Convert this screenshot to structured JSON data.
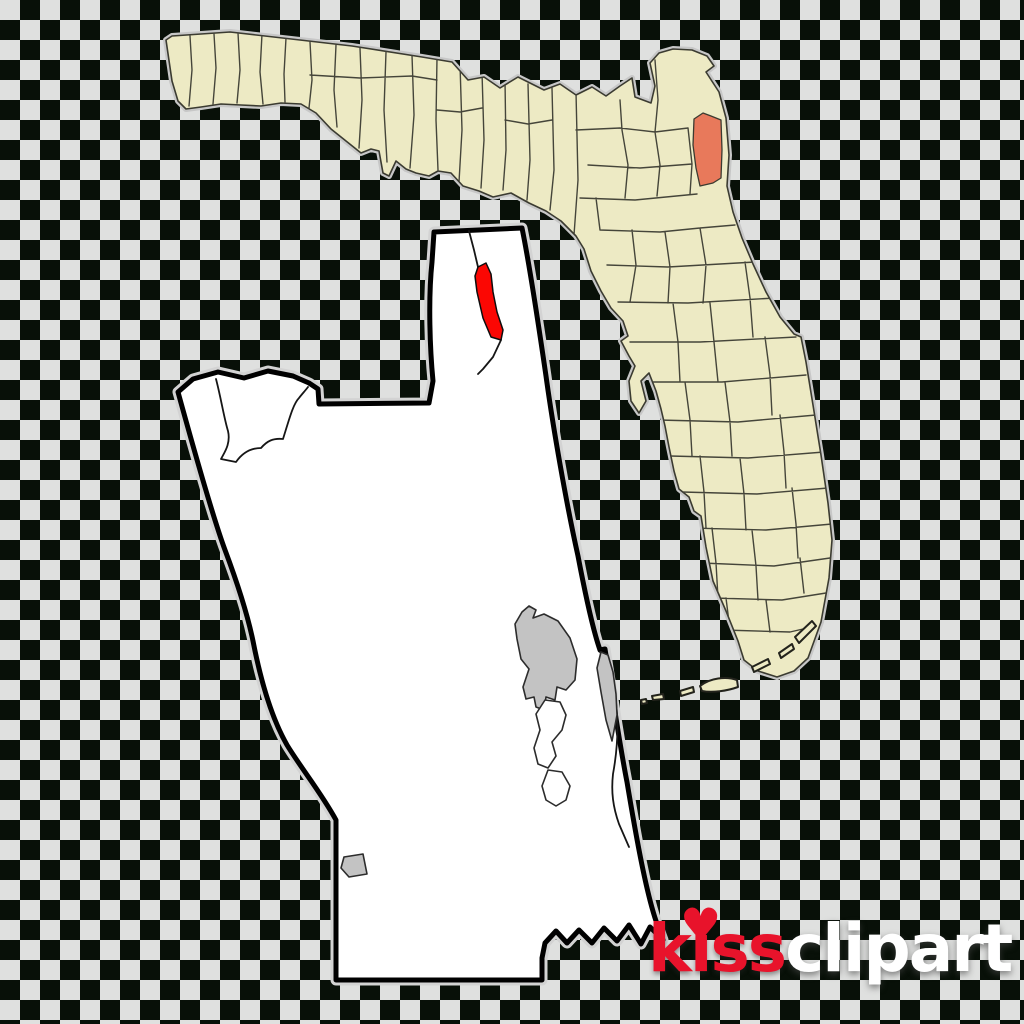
{
  "watermark": {
    "kiss_text": "kiss",
    "clipart_text": "clipart",
    "heart_glyph": "♥",
    "kiss_color": "#e8132b",
    "clipart_color": "#ffffff"
  },
  "colors": {
    "checker_dark": "#081008",
    "checker_light": "#dfe0df",
    "state_fill": "#edeac4",
    "state_line": "#3b3b31",
    "highlight_county_fill": "#e8795b",
    "county_map_fill": "#ffffff",
    "county_map_outline": "#000000",
    "highlight_place_fill": "#fb0703",
    "urban_area_fill": "#c3c3c3"
  },
  "geometry": {
    "state_outline": "M166,40 L172,36 L230,32 L300,40 L352,46 L422,57 L452,62 L468,80 L484,77 L500,88 L518,77 L544,90 L560,84 L576,95 L592,87 L606,96 L620,86 L632,78 L635,97 L651,103 L655,86 L650,63 L659,53 L673,49 L692,50 L707,56 L714,66 L706,72 L719,92 L726,118 L729,155 L727,186 L733,212 L742,238 L753,264 L766,292 L780,317 L794,334 L801,337 L806,362 L813,405 L821,455 L828,503 L832,540 L829,578 L821,622 L808,658 L794,671 L777,677 L758,671 L744,660 L738,641 L726,611 L713,581 L706,547 L701,516 L694,511 L689,497 L679,489 L674,471 L669,447 L665,426 L661,409 L656,391 L649,373 L641,381 L646,401 L639,413 L631,401 L629,381 L635,366 L629,356 L621,341 L628,336 L623,321 L611,308 L601,291 L591,271 L584,249 L576,236 L561,221 L546,211 L529,203 L511,193 L493,197 L479,191 L463,186 L451,173 L438,171 L429,176 L416,173 L406,169 L396,161 L389,176 L383,173 L379,151 L371,149 L361,153 L346,141 L331,129 L316,113 L301,104 L281,103 L261,106 L241,105 L221,104 L201,107 L186,109 L178,101 L172,81 Z",
    "county_mesh": "M190,36 L192,70 L189,106 M214,34 L216,68 L213,104 M238,33 L240,70 L237,103 M262,34 L260,72 L263,104 M286,38 L284,74 L285,102 M310,42 L312,80 L309,108 M336,45 L334,90 L337,127 M360,48 L362,100 L359,148 M386,52 L384,110 L387,162 M412,55 L414,115 L410,168 M437,58 L436,120 L438,170 M460,64 L462,130 L459,182 M482,72 L484,140 L481,188 M505,80 L506,150 L503,190 M528,84 L530,160 L527,200 M552,88 L554,170 L550,210 M576,92 L578,180 L574,235 M310,75 L360,78 L412,76 L437,80 M437,110 L460,112 L482,108 M505,120 L528,124 L552,120 M576,130 L620,128 L655,132 L688,128 M588,165 L640,168 L692,164 M580,198 L635,200 L697,194 M600,230 L660,232 L700,228 L735,225 M607,265 L668,267 L755,262 M618,302 L688,303 L775,298 M630,342 L700,342 L796,337 M645,382 L722,382 L806,375 M658,420 L738,422 L816,415 M670,456 L748,458 L824,452 M682,492 L757,494 L828,488 M692,528 L766,530 L832,524 M702,563 L774,566 L830,558 M713,598 L782,600 L826,593 M723,630 L790,632 L816,626 M620,100 L622,130 M655,60 L658,100 L655,132 M622,130 L628,165 L625,198 M655,132 L660,165 L657,196 M688,128 L692,164 L690,194 M600,230 L596,198 M632,230 L636,265 L630,302 M665,232 L670,267 L668,303 M700,228 L706,265 L703,303 M673,303 L678,342 L680,382 M710,303 L714,342 L718,382 M745,262 L750,298 L753,337 M685,382 L690,420 L692,456 M725,382 L730,422 L732,456 M765,337 L770,375 L772,415 M700,456 L704,492 L706,528 M740,458 L744,494 L746,530 M780,415 L784,452 L786,488 M712,528 L716,563 L718,598 M752,530 L756,566 L758,600 M792,488 L796,524 L798,558 M726,598 L730,630 M766,600 L770,632 M800,558 L804,593",
    "highlight_county": "M694,119 L703,113 L711,116 L721,120 L722,150 L721,178 L713,183 L700,186 L696,168 L693,145 Z",
    "keys": "M795,637 L812,621 L816,626 L799,643 Z M779,653 L792,644 L794,649 L781,658 Z M752,667 L768,659 L770,664 L754,672 Z M700,686 C710,678 726,676 737,680 L738,687 C727,691 712,693 702,691 Z M680,691 L693,687 L694,692 L681,696 Z M652,696 L663,694 L664,699 L653,700 Z M641,700 L646,699 L647,703 L642,704 Z",
    "county_outline": "M434,232 L522,228 C529,262 539,328 546,376 C553,427 566,502 578,556 C586,598 594,633 600,650 L605,649 C612,692 620,747 627,782 C635,830 647,900 659,929 L663,940 L650,927 L641,944 L629,925 L617,941 L604,928 L592,943 L579,930 L567,943 L556,931 L545,943 L542,958 L542,980 L336,980 L336,820 C322,794 301,768 287,745 C271,717 260,677 253,641 C247,612 237,582 225,550 C215,523 197,461 178,392 L193,379 L218,372 L244,378 L268,371 L293,376 L309,383 L318,389 L319,404 L429,403 L433,381 C430,350 428,300 432,262 Z",
    "county_internal_lines": "M469,231 L474,250 L478,267 M501,340 L493,357 L483,369 L478,374 M216,379 C221,398 224,418 228,431 C231,444 224,453 221,459 L236,462 C243,452 252,448 261,448 C267,441 273,438 283,439 C289,420 293,404 299,398 C302,394 305,391 308,387 M600,652 C608,662 613,682 616,702 C619,727 617,752 613,774 C611,792 613,807 619,824 L629,847",
    "highlight_place": "M478,267 L486,263 L491,274 L493,292 L497,312 L503,330 L501,340 L491,337 L483,318 L477,292 L475,276 Z",
    "urban_main": "M522,612 L529,606 L536,610 L533,618 L544,614 L558,621 L570,638 L577,659 L575,680 L566,690 L557,687 L555,700 L546,697 L544,710 L536,707 L534,697 L526,699 L523,687 L529,669 L521,659 L517,639 L515,624 Z",
    "urban_coastal": "M601,652 L608,655 L613,672 L616,694 L617,715 L612,741 L606,720 L601,692 L597,668 Z",
    "white_places": "M545,700 L560,702 L566,715 L562,730 L552,742 L556,756 L548,768 L538,764 L534,748 L540,730 L536,714 Z M548,770 L562,772 L570,786 L566,800 L556,806 L546,800 L542,786 Z",
    "urban_small": "M344,857 L363,854 L367,874 L349,877 L341,868 Z"
  }
}
